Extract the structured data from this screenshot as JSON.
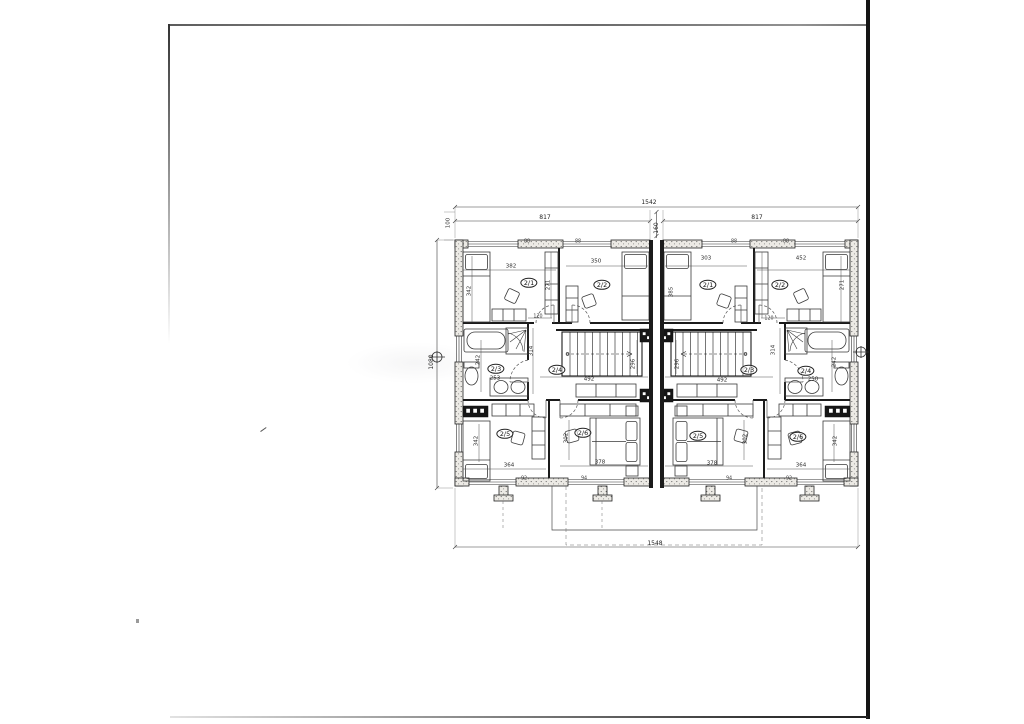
{
  "labels": [
    {
      "name": "dim-overall-width-top",
      "text": "1542"
    },
    {
      "name": "dim-unit-left-width",
      "text": "817"
    },
    {
      "name": "dim-unit-right-width",
      "text": "817"
    },
    {
      "name": "dim-party-wall-width",
      "text": "160"
    },
    {
      "name": "dim-wall-offset",
      "text": "100"
    },
    {
      "name": "dim-overall-depth-left",
      "text": "1080"
    },
    {
      "name": "dim-overall-width-bottom",
      "text": "1548"
    },
    {
      "name": "room-left-2-1",
      "text": "2/1"
    },
    {
      "name": "room-left-2-2",
      "text": "2/2"
    },
    {
      "name": "dim-left-room21-width",
      "text": "382"
    },
    {
      "name": "dim-left-room22-width",
      "text": "350"
    },
    {
      "name": "dim-left-room21-bed",
      "text": "342"
    },
    {
      "name": "dim-left-partition",
      "text": "271"
    },
    {
      "name": "dim-left-door",
      "text": "120"
    },
    {
      "name": "dim-left-bath-depth",
      "text": "314"
    },
    {
      "name": "room-left-2-3",
      "text": "2/3"
    },
    {
      "name": "dim-left-bath-width",
      "text": "253"
    },
    {
      "name": "room-left-2-4",
      "text": "2/4"
    },
    {
      "name": "dim-left-hall-width",
      "text": "492"
    },
    {
      "name": "dim-left-stair-width",
      "text": "296"
    },
    {
      "name": "dim-left-wc",
      "text": "242"
    },
    {
      "name": "room-left-2-5",
      "text": "2/5"
    },
    {
      "name": "room-left-2-6",
      "text": "2/6"
    },
    {
      "name": "dim-left-room25-width",
      "text": "364"
    },
    {
      "name": "dim-left-room26-width",
      "text": "378"
    },
    {
      "name": "dim-left-room25-bed",
      "text": "342"
    },
    {
      "name": "dim-left-room26-depth",
      "text": "302"
    },
    {
      "name": "wall-mark-left-a",
      "text": "92"
    },
    {
      "name": "wall-mark-left-b",
      "text": "94"
    },
    {
      "name": "wall-mark-left-c",
      "text": "88"
    },
    {
      "name": "wall-mark-left-d",
      "text": "88"
    },
    {
      "name": "room-right-2-1",
      "text": "2/1"
    },
    {
      "name": "room-right-2-2",
      "text": "2/2"
    },
    {
      "name": "dim-right-room21-width",
      "text": "303"
    },
    {
      "name": "dim-right-room22-width",
      "text": "452"
    },
    {
      "name": "dim-right-room21-bed",
      "text": "385"
    },
    {
      "name": "dim-right-partition",
      "text": "271"
    },
    {
      "name": "dim-right-door",
      "text": "120"
    },
    {
      "name": "dim-right-bath-depth",
      "text": "314"
    },
    {
      "name": "room-right-2-3",
      "text": "2/3"
    },
    {
      "name": "room-right-2-4",
      "text": "2/4"
    },
    {
      "name": "dim-right-bath-width",
      "text": "250"
    },
    {
      "name": "dim-right-hall-width",
      "text": "492"
    },
    {
      "name": "dim-right-stair-width",
      "text": "296"
    },
    {
      "name": "dim-right-wc",
      "text": "242"
    },
    {
      "name": "room-right-2-5",
      "text": "2/5"
    },
    {
      "name": "room-right-2-6",
      "text": "2/6"
    },
    {
      "name": "dim-right-room25-width",
      "text": "378"
    },
    {
      "name": "dim-right-room26-width",
      "text": "364"
    },
    {
      "name": "dim-right-room25-depth",
      "text": "302"
    },
    {
      "name": "dim-right-room26-bed",
      "text": "342"
    },
    {
      "name": "wall-mark-right-a",
      "text": "94"
    },
    {
      "name": "wall-mark-right-b",
      "text": "92"
    },
    {
      "name": "wall-mark-right-c",
      "text": "88"
    },
    {
      "name": "wall-mark-right-d",
      "text": "88"
    }
  ],
  "building": {
    "units": [
      {
        "name": "left-unit",
        "rooms": [
          "2/1",
          "2/2",
          "2/3",
          "2/4",
          "2/5",
          "2/6"
        ]
      },
      {
        "name": "right-unit",
        "rooms": [
          "2/1",
          "2/2",
          "2/3",
          "2/4",
          "2/5",
          "2/6"
        ]
      }
    ]
  }
}
